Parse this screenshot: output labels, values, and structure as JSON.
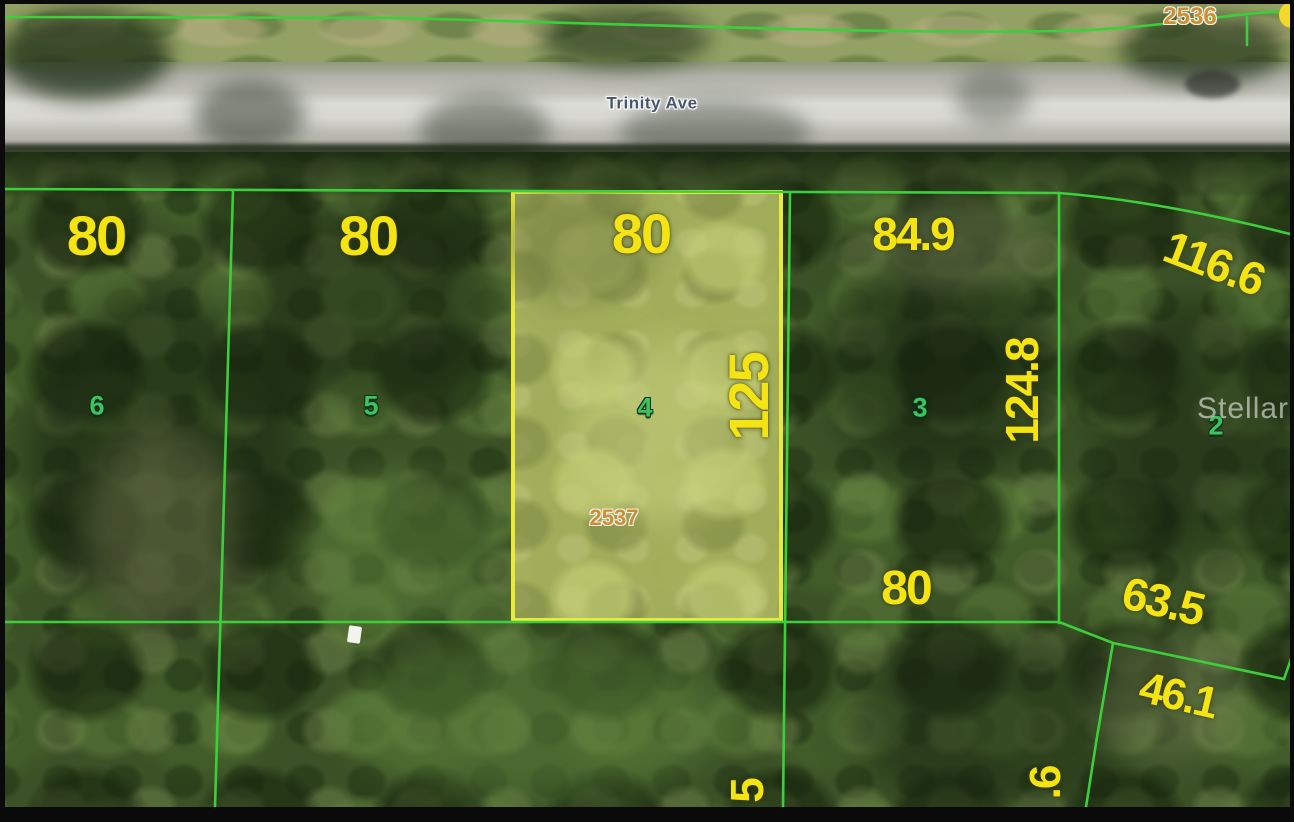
{
  "map": {
    "road": {
      "name": "Trinity Ave"
    },
    "watermark": "StellarMLS",
    "parcels": {
      "across_street_id": "2536",
      "highlighted_id": "2537"
    },
    "lots": [
      {
        "number": "6"
      },
      {
        "number": "5"
      },
      {
        "number": "4"
      },
      {
        "number": "3"
      },
      {
        "number": "2"
      }
    ],
    "dimensions": [
      {
        "text": "80",
        "where": "lot6-frontage"
      },
      {
        "text": "80",
        "where": "lot5-frontage"
      },
      {
        "text": "80",
        "where": "lot4-frontage"
      },
      {
        "text": "84.9",
        "where": "lot3-frontage"
      },
      {
        "text": "116.6",
        "where": "lot2-frontage"
      },
      {
        "text": "125",
        "where": "lot4-side"
      },
      {
        "text": "124.8",
        "where": "lot3-side"
      },
      {
        "text": "80",
        "where": "lot3-rear"
      },
      {
        "text": "63.5",
        "where": "rear-segment"
      },
      {
        "text": "46.1",
        "where": "rear-segment-2"
      },
      {
        "text": "5",
        "where": "south-lot-side-partial"
      },
      {
        "text": ".6",
        "where": "south-lot-side-partial-2"
      }
    ],
    "colors": {
      "lot_line_green": "#3ccf3c",
      "highlight_border_yellow": "#e9e93e",
      "dimension_yellow": "#f5e414",
      "lot_number_green": "#40c261",
      "parcel_id_orange": "#cb8f35",
      "road_gray": "#c9c9c1"
    }
  }
}
